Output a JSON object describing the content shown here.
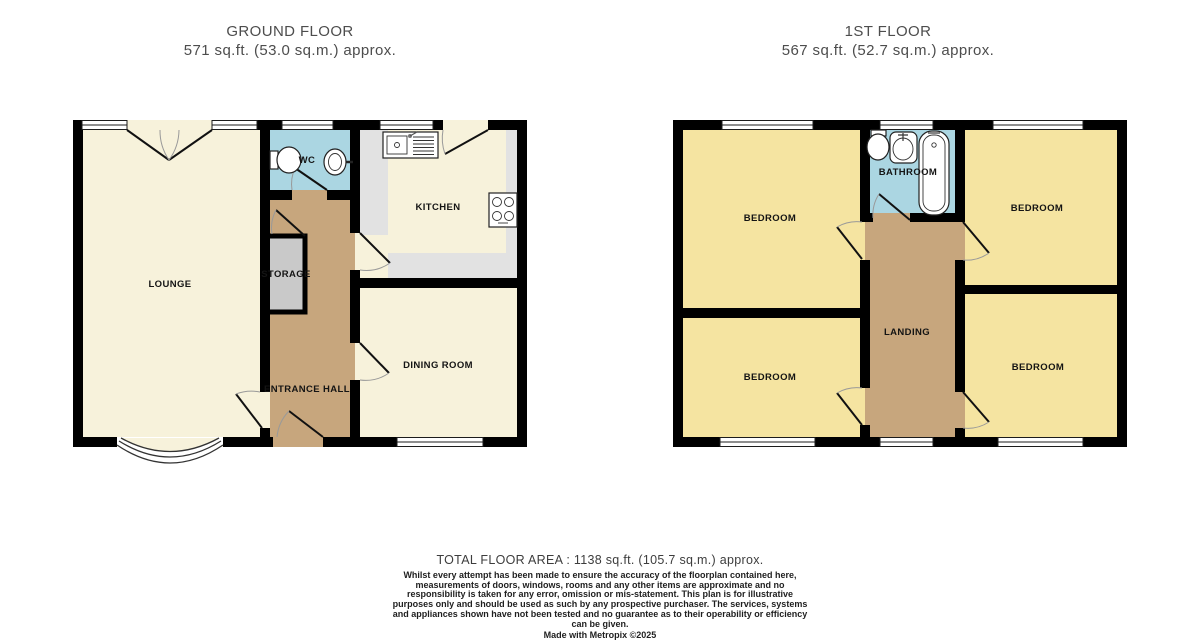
{
  "titles": {
    "ground": {
      "name": "GROUND FLOOR",
      "area": "571 sq.ft. (53.0 sq.m.) approx."
    },
    "first": {
      "name": "1ST FLOOR",
      "area": "567 sq.ft. (52.7 sq.m.) approx."
    }
  },
  "ground_floor": {
    "rooms": {
      "lounge": "LOUNGE",
      "wc": "WC",
      "kitchen": "KITCHEN",
      "storage": "STORAGE",
      "entrance_hall": "ENTRANCE HALL",
      "dining_room": "DINING ROOM"
    }
  },
  "first_floor": {
    "rooms": {
      "bedroom_top_left": "BEDROOM",
      "bedroom_top_right": "BEDROOM",
      "bedroom_bottom_left": "BEDROOM",
      "bedroom_bottom_right": "BEDROOM",
      "bathroom": "BATHROOM",
      "landing": "LANDING"
    }
  },
  "footer": {
    "total_area": "TOTAL FLOOR AREA : 1138 sq.ft. (105.7 sq.m.) approx.",
    "disclaimer": "Whilst every attempt has been made to ensure the accuracy of the floorplan contained here, measurements of doors, windows, rooms and any other items are approximate and no responsibility is taken for any error, omission or mis-statement. This plan is for illustrative purposes only and should be used as such by any prospective purchaser. The services, systems and appliances shown have not been tested and no guarantee as to their operability or efficiency can be given.",
    "credit": "Made with Metropix ©2025"
  },
  "colors": {
    "wall": "#000000",
    "room-cream": "#f7f2db",
    "room-yellow": "#f5e4a1",
    "room-blue": "#abd6e2",
    "room-tan": "#c7a67d",
    "storage-gray": "#c9c9c9",
    "counter-gray": "#e2e2e2",
    "title-text": "#4d4d4d",
    "label-text": "#141414"
  }
}
